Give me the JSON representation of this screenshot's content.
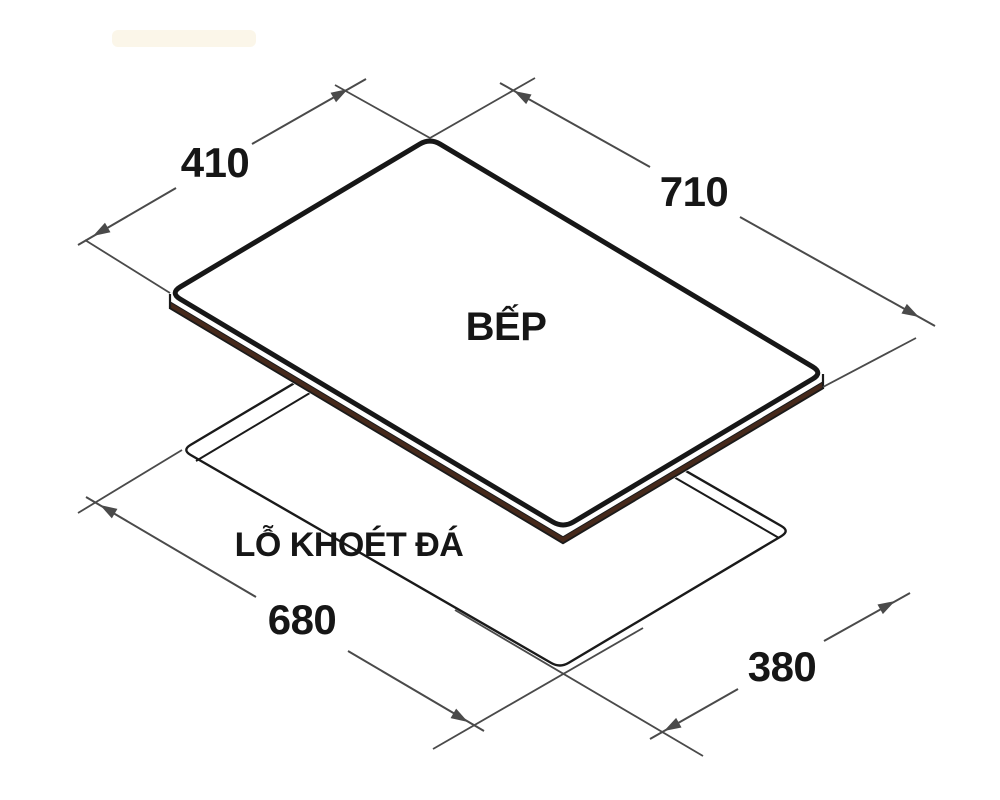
{
  "diagram": {
    "product_label": "BẾP",
    "cutout_label": "LỖ KHOÉT ĐÁ",
    "dimensions": {
      "cooktop_width": "410",
      "cooktop_length": "710",
      "cutout_length": "680",
      "cutout_width": "380"
    },
    "colors": {
      "line": "#1a1a1a",
      "dimension_line": "#4a4a4a",
      "glass_edge_brown": "#46291b",
      "watermark": "#fbf6e9",
      "text": "#161616"
    }
  }
}
